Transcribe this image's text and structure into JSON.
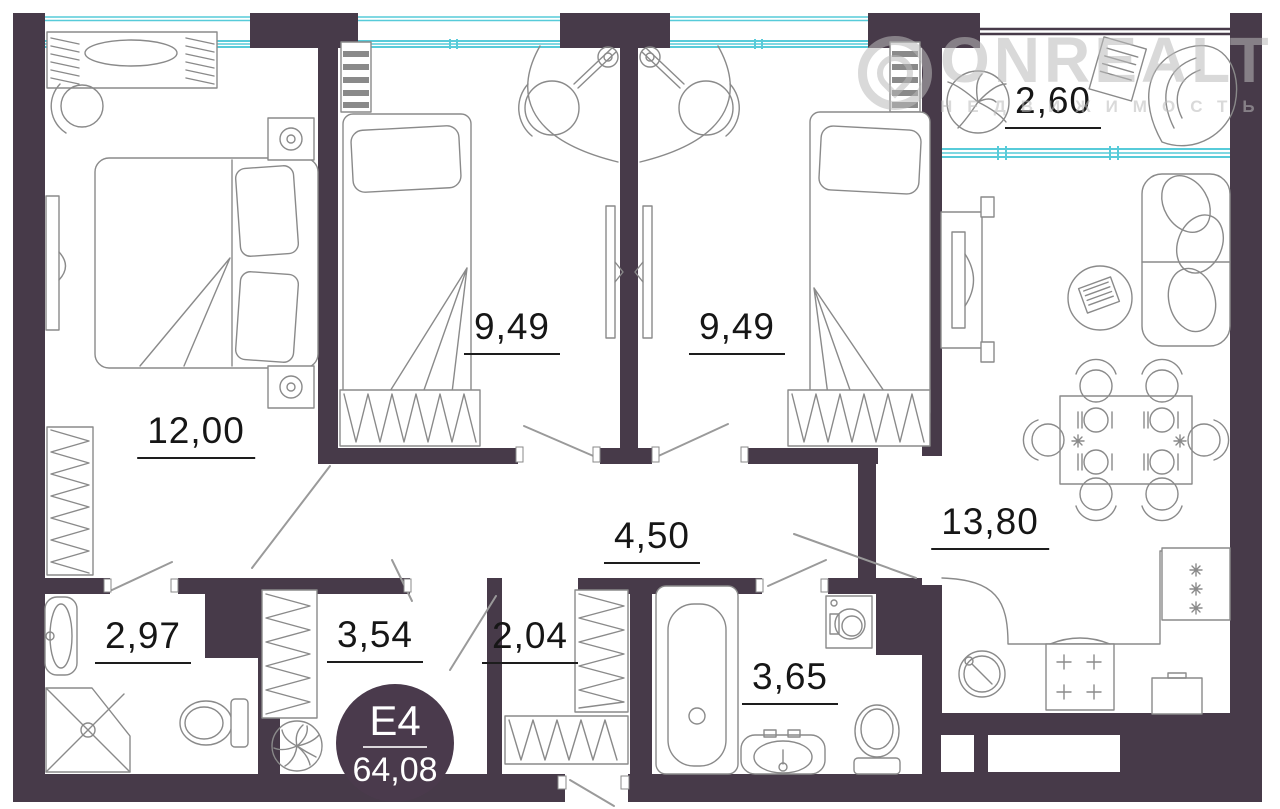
{
  "plan": {
    "badge": {
      "unit": "E4",
      "total_area": "64,08"
    },
    "watermark": {
      "brand": "ONREALT",
      "subtitle": "НЕДВИЖИМОСТЬ"
    },
    "rooms": {
      "master_bedroom": {
        "area": "12,00"
      },
      "bedroom_left": {
        "area": "9,49"
      },
      "bedroom_right": {
        "area": "9,49"
      },
      "balcony": {
        "area": "2,60"
      },
      "living_kitchen": {
        "area": "13,80"
      },
      "hallway": {
        "area": "4,50"
      },
      "bathroom_small": {
        "area": "2,97"
      },
      "wardrobe_left": {
        "area": "3,54"
      },
      "wardrobe_right": {
        "area": "2,04"
      },
      "bathroom_large": {
        "area": "3,65"
      }
    },
    "colors": {
      "wall": "#473a49",
      "glazing": "#57cbd9",
      "furniture_line": "#8a8a8a",
      "label_text": "#161616",
      "badge_bg": "#4a3a4c",
      "badge_text": "#ffffff",
      "watermark": "#bababa"
    }
  }
}
